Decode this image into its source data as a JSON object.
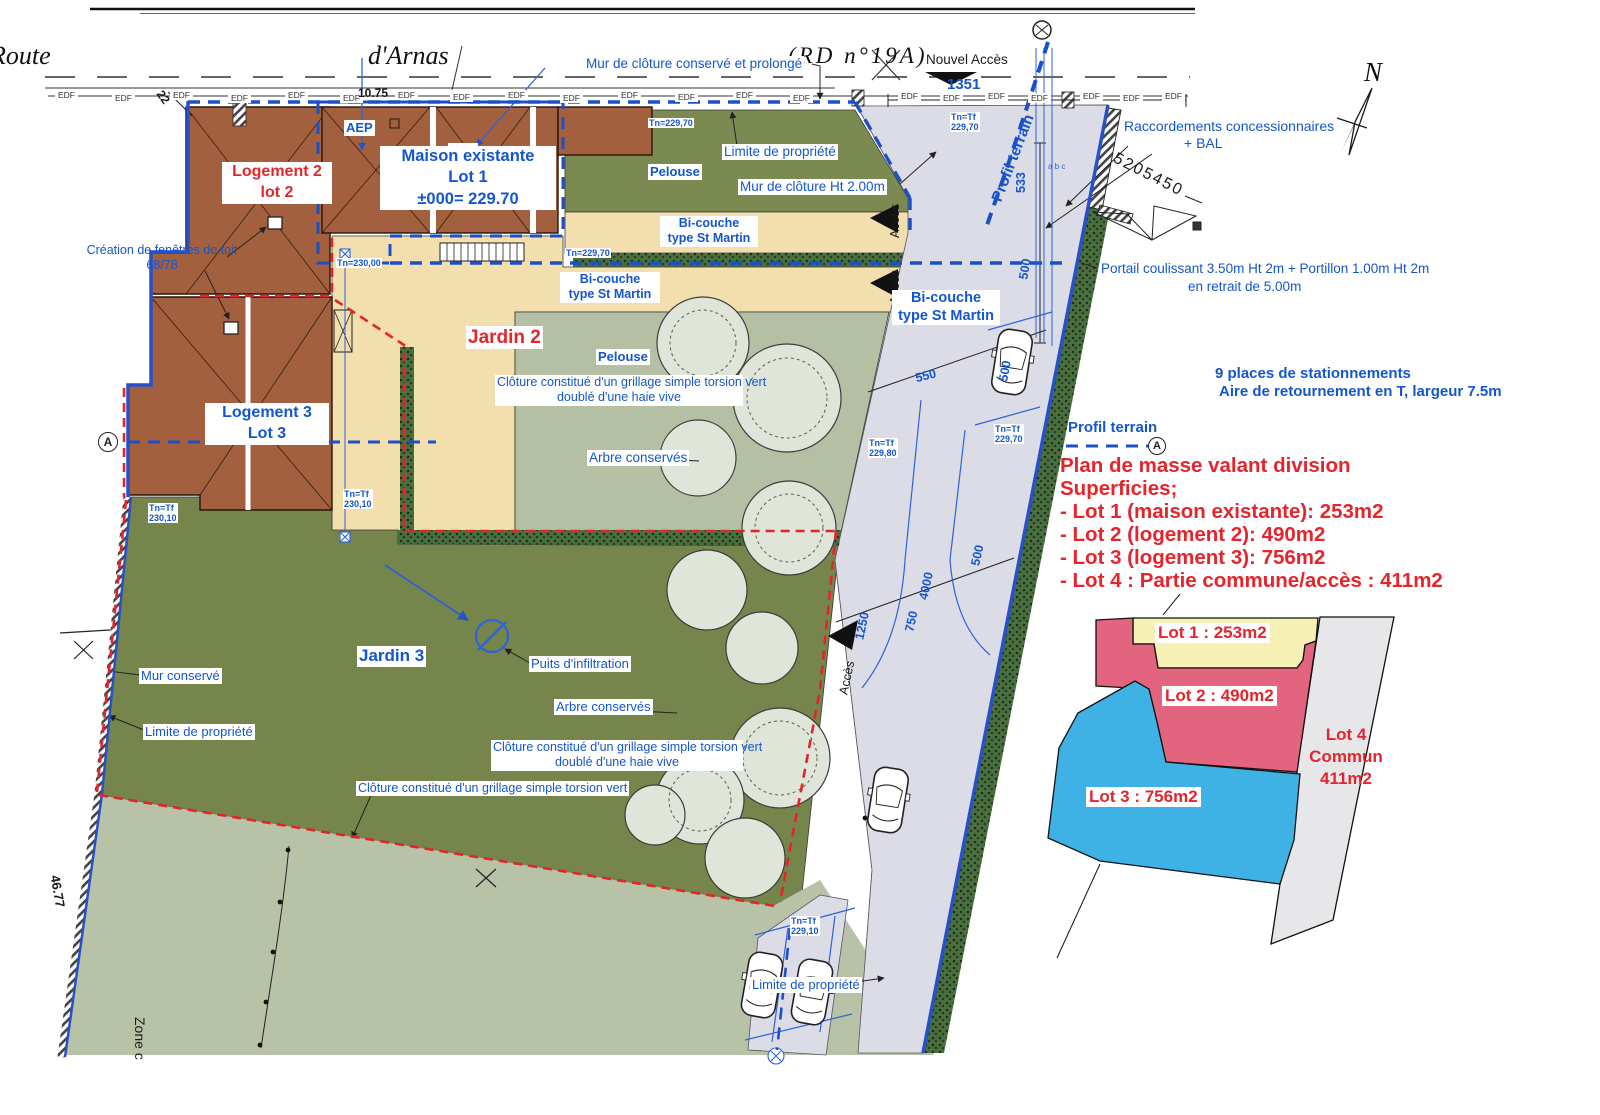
{
  "colors": {
    "label_blue": "#1456cf",
    "annot_red": "#e6242b",
    "boundary_blue": "#2850c8",
    "dash_red": "#e3242b",
    "roof_brown": "#a2603e",
    "tan_bicouche": "#f3dfae",
    "lawn_dark": "#7b8a50",
    "lawn_mid": "#b5bfa3",
    "lawn_light": "#b8c2a6",
    "garden_green": "#75854b",
    "road_grey": "#dcdce6",
    "hedge_green": "#4a7040",
    "lot1_yellow": "#f7f0b4",
    "lot2_pink": "#e2647e",
    "lot3_blue": "#3fb2e5",
    "lot4_grey": "#e7e7ea"
  },
  "roadtop": {
    "route": "Route",
    "arnas": "d'Arnas",
    "rd": "(RD n°19A)",
    "nouvel_acces": "Nouvel Accès",
    "edf": "EDF",
    "dim_1351": "1351",
    "dim_22": "22",
    "dim_1075": "10.75",
    "profil_terrain": "Profil terrain",
    "mur_cloture": "Mur de clôture conservé et prolongé",
    "north": "N"
  },
  "labels": {
    "aep": "AEP",
    "edf": "EDF",
    "maison_1": "Maison existante",
    "maison_2": "Lot 1",
    "maison_3": "±000= 229.70",
    "log2_1": "Logement 2",
    "log2_2": "lot 2",
    "log3_1": "Logement 3",
    "log3_2": "Lot 3",
    "fenetres_1": "Création de fenêtres de toit",
    "fenetres_2": "68/78",
    "limite": "Limite de propriété",
    "pelouse": "Pelouse",
    "mur_ht": "Mur de clôture Ht 2.00m",
    "bicouche_1": "Bi-couche",
    "bicouche_2": "type St Martin",
    "acces": "Accès",
    "jardin2": "Jardin 2",
    "jardin3": "Jardin 3",
    "cloture_1": "Clôture constitué d'un grillage simple torsion vert",
    "cloture_2": "doublé d'une haie vive",
    "arbre": "Arbre conservés",
    "puits": "Puits d'infiltration",
    "mur_conserve": "Mur conservé",
    "zone": "Zone c",
    "dim_4677": "46.77",
    "section_a": "A",
    "abc": "a b c"
  },
  "tn": {
    "t22970": "Tn=229,70",
    "t23000": "Tn=230,00",
    "tf": "Tn=Tf",
    "v22970": "229,70",
    "v23010": "230,10",
    "v22980": "229,80",
    "v22910": "229,10"
  },
  "dims": {
    "d533": "533",
    "d500": "500",
    "d550": "550",
    "d4000": "4000",
    "d750": "750",
    "d1250": "1250"
  },
  "notes": {
    "raccord_1": "Raccordements concessionnaires",
    "raccord_2": "+ BAL",
    "coord": "5205450",
    "portail_1": "Portail coulissant 3.50m Ht 2m + Portillon 1.00m Ht 2m",
    "portail_2": "en retrait de 5.00m",
    "places_1": "9 places de stationnements",
    "places_2": "Aire de retournement en T, largeur 7.5m",
    "profil": "Profil terrain"
  },
  "summary": {
    "title": "Plan de masse valant division",
    "subtitle": "Superficies;",
    "lots": [
      "- Lot 1 (maison existante): 253m2",
      "- Lot 2 (logement 2): 490m2",
      "- Lot 3 (logement 3): 756m2",
      "- Lot 4 : Partie commune/accès : 411m2"
    ]
  },
  "inset": {
    "lot1": "Lot 1 : 253m2",
    "lot2": "Lot 2 : 490m2",
    "lot3": "Lot 3 : 756m2",
    "lot4_1": "Lot 4",
    "lot4_2": "Commun",
    "lot4_3": "411m2"
  }
}
